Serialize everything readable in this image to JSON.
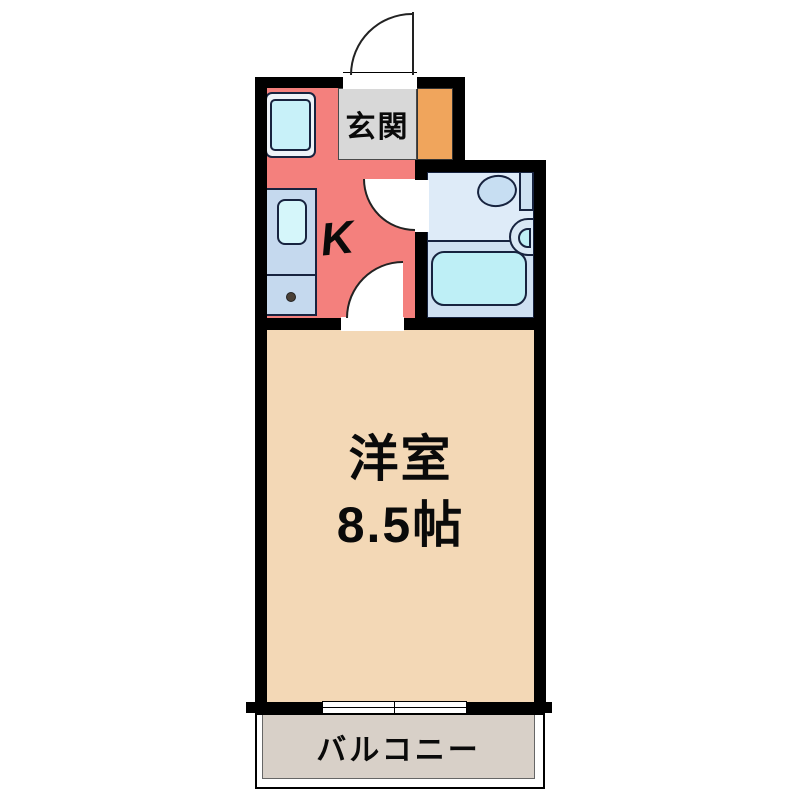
{
  "plan": {
    "type": "apartment-floor-plan",
    "rooms": {
      "entrance": {
        "label": "玄関"
      },
      "kitchen": {
        "label": "K"
      },
      "bathroom": {
        "fixtures": [
          "toilet",
          "wash-basin",
          "bathtub"
        ]
      },
      "main_room": {
        "name": "洋室",
        "size": "8.5帖"
      },
      "balcony": {
        "label": "バルコニー"
      }
    },
    "colors": {
      "wall": "#000000",
      "kitchen_floor": "#F4807D",
      "entrance_floor": "#D8D8D8",
      "entrance_storage": "#F0A55C",
      "bathroom_floor_upper": "#DEEBF8",
      "bathroom_floor_lower": "#CFE0F1",
      "bathtub_water": "#BEEFF6",
      "main_room_floor": "#F3D8B6",
      "balcony_floor": "#D8D0C8",
      "fixture_outline": "#17233F",
      "background": "#FFFFFF"
    }
  }
}
